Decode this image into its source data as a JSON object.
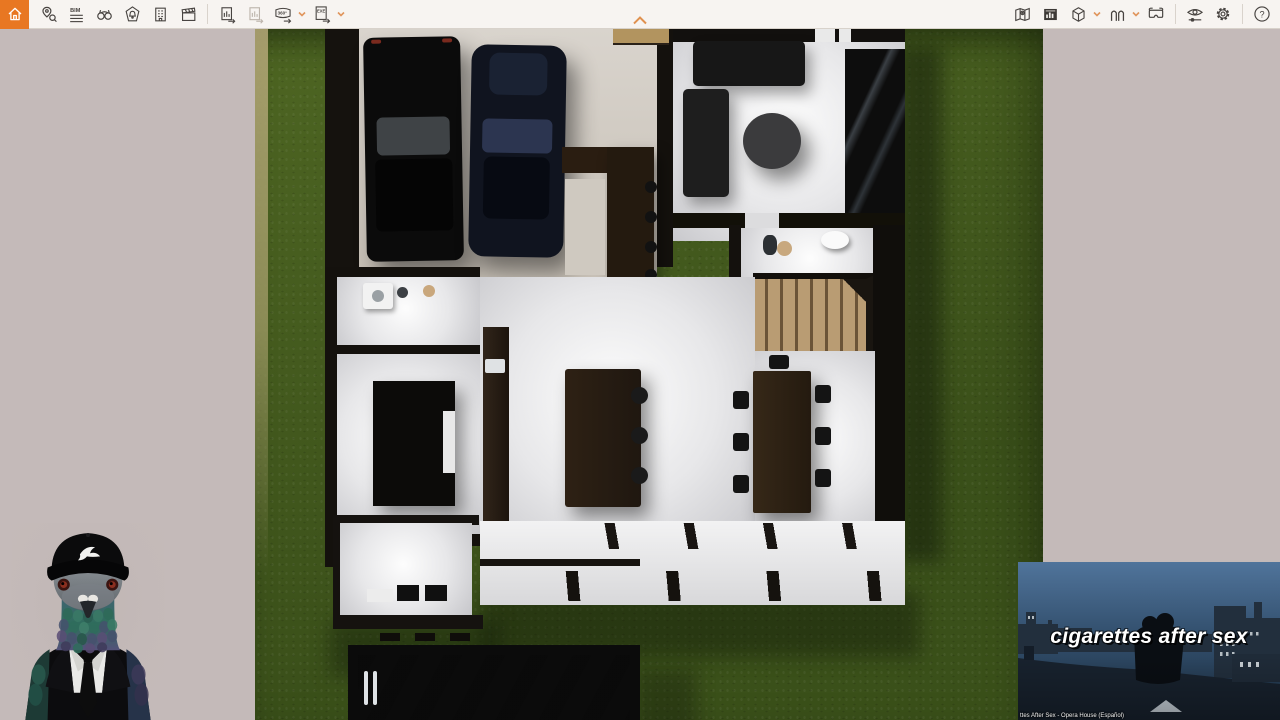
{
  "toolbar": {
    "bim_icon_text": "BIM",
    "pano_icon_text": "360°",
    "exe_icon_text": "EXE",
    "help_label": "?",
    "left_icons": [
      "home-icon",
      "site-context-pin-icon",
      "bim-mode-icon",
      "binoculars-icon",
      "view-management-bell-icon",
      "building-icon",
      "video-editor-clapper-icon",
      "screenshot-export-icon",
      "batch-export-icon",
      "panorama-360-export-icon",
      "exe-export-icon"
    ],
    "dropdown_icons": [
      "panorama-dropdown-chevron",
      "exe-dropdown-chevron",
      "cube-dropdown-chevron",
      "walk-mode-dropdown-chevron"
    ],
    "right_icons": [
      "minimap-icon",
      "asset-panel-chart-icon",
      "cube-icon",
      "walk-mode-icon",
      "vr-headset-icon",
      "visual-settings-eye-icon",
      "settings-gear-icon",
      "help-icon"
    ],
    "collapse_icon": "chevron-up-icon"
  },
  "colors": {
    "accent_orange": "#e87722",
    "toolbar_bg": "#f7f4f1",
    "toolbar_icon": "#474340",
    "canvas_bg": "#c4bab9",
    "lawn_green": "#47611f",
    "pool_water": "#24415f",
    "video_sky": "#44678a"
  },
  "video_overlay": {
    "title": "cigarettes after sex",
    "caption": "ttes After Sex - Opera House (Español)"
  },
  "overlays": {
    "pigeon": "pigeon-in-suit-overlay"
  }
}
